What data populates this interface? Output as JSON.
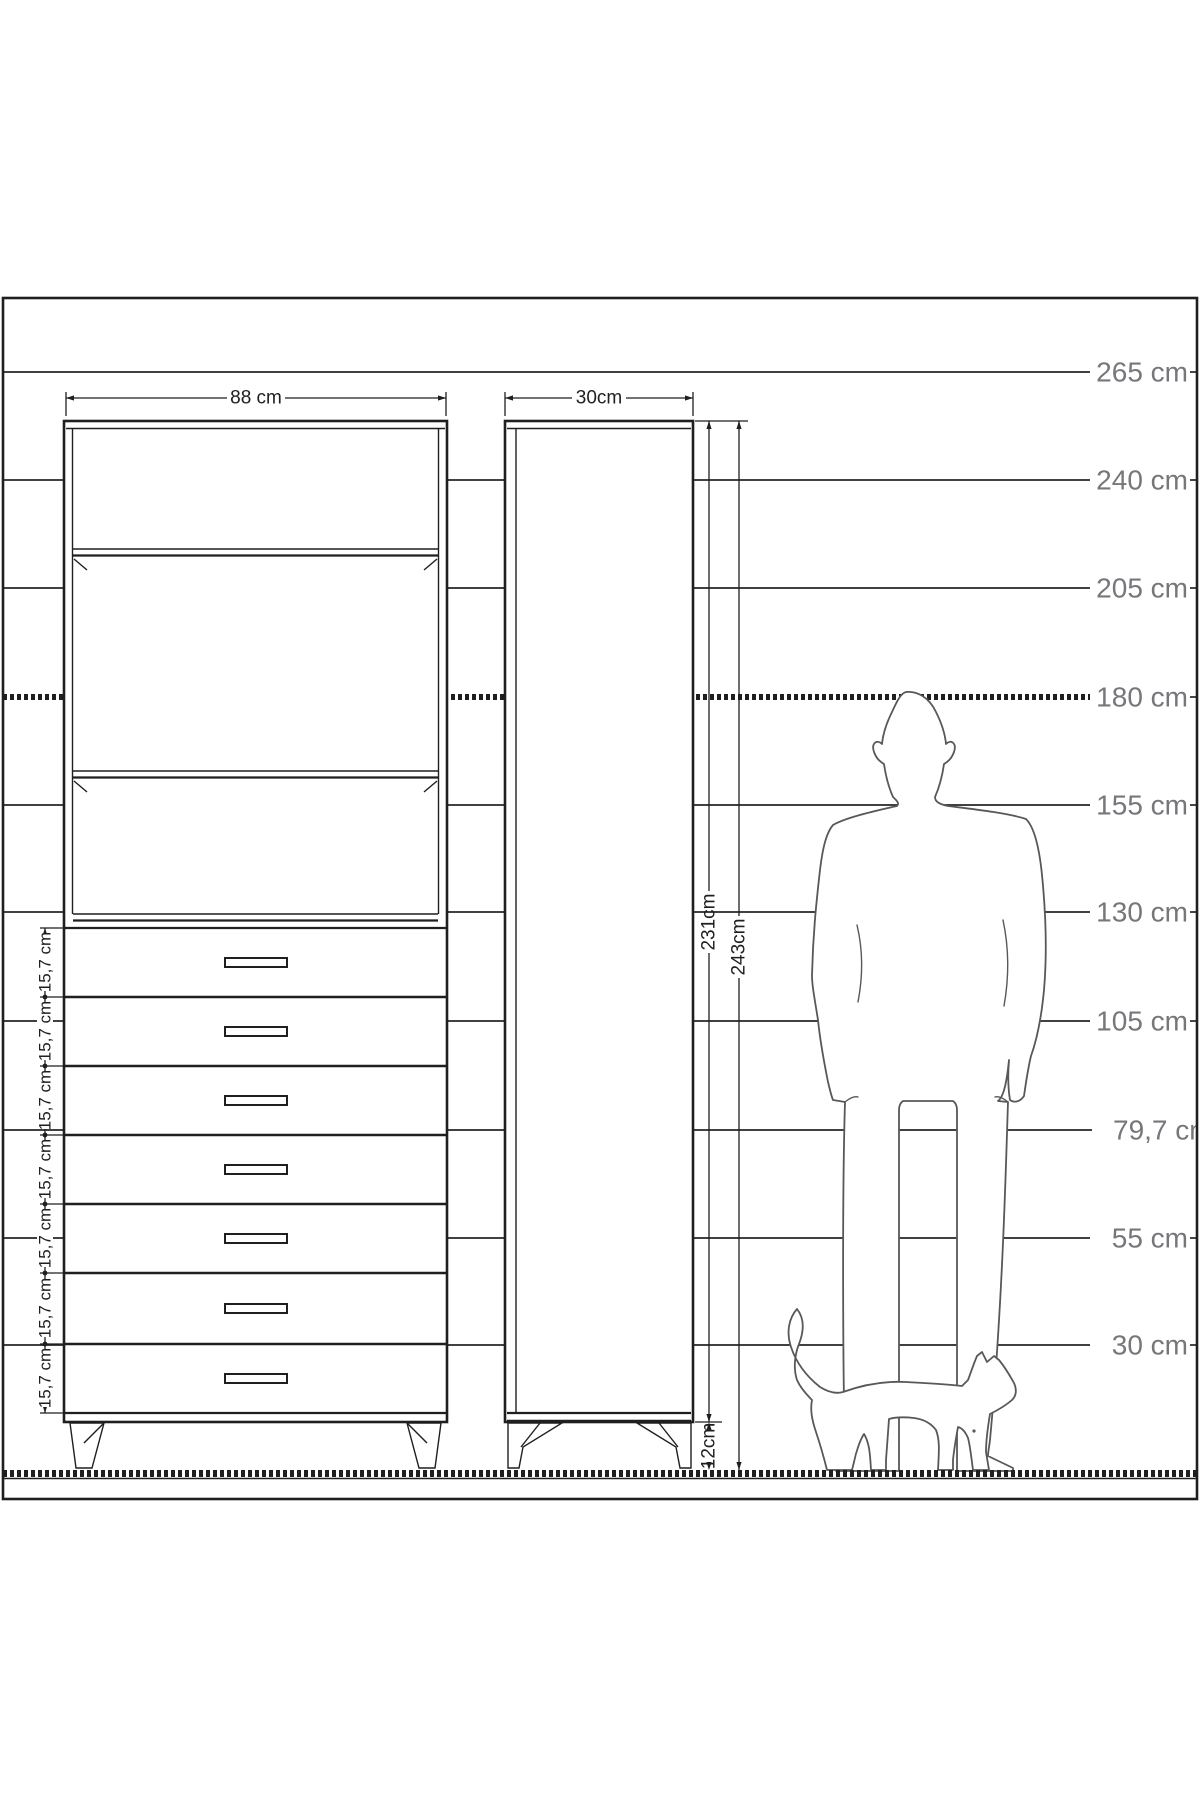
{
  "height_scale": {
    "labels": [
      "265 cm",
      "240 cm",
      "205 cm",
      "180 cm",
      "155 cm",
      "130 cm",
      "105 cm",
      "79,7 cm",
      "55 cm",
      "30 cm"
    ]
  },
  "front_view": {
    "width_label": "88 cm",
    "drawer_labels": [
      "15,7 cm",
      "15,7 cm",
      "15,7 cm",
      "15,7 cm",
      "15,7 cm",
      "15,7 cm",
      "15,7 cm"
    ]
  },
  "side_view": {
    "depth_label": "30cm",
    "cabinet_height_label": "231cm",
    "total_height_label": "243cm",
    "leg_height_label": "12cm"
  },
  "icons": {
    "man": "standing-man-silhouette",
    "cat": "walking-cat-silhouette"
  },
  "colors": {
    "line": "#1f1f1f",
    "scale_label": "#76777b",
    "silhouette": "#58585a",
    "background": "#ffffff"
  }
}
